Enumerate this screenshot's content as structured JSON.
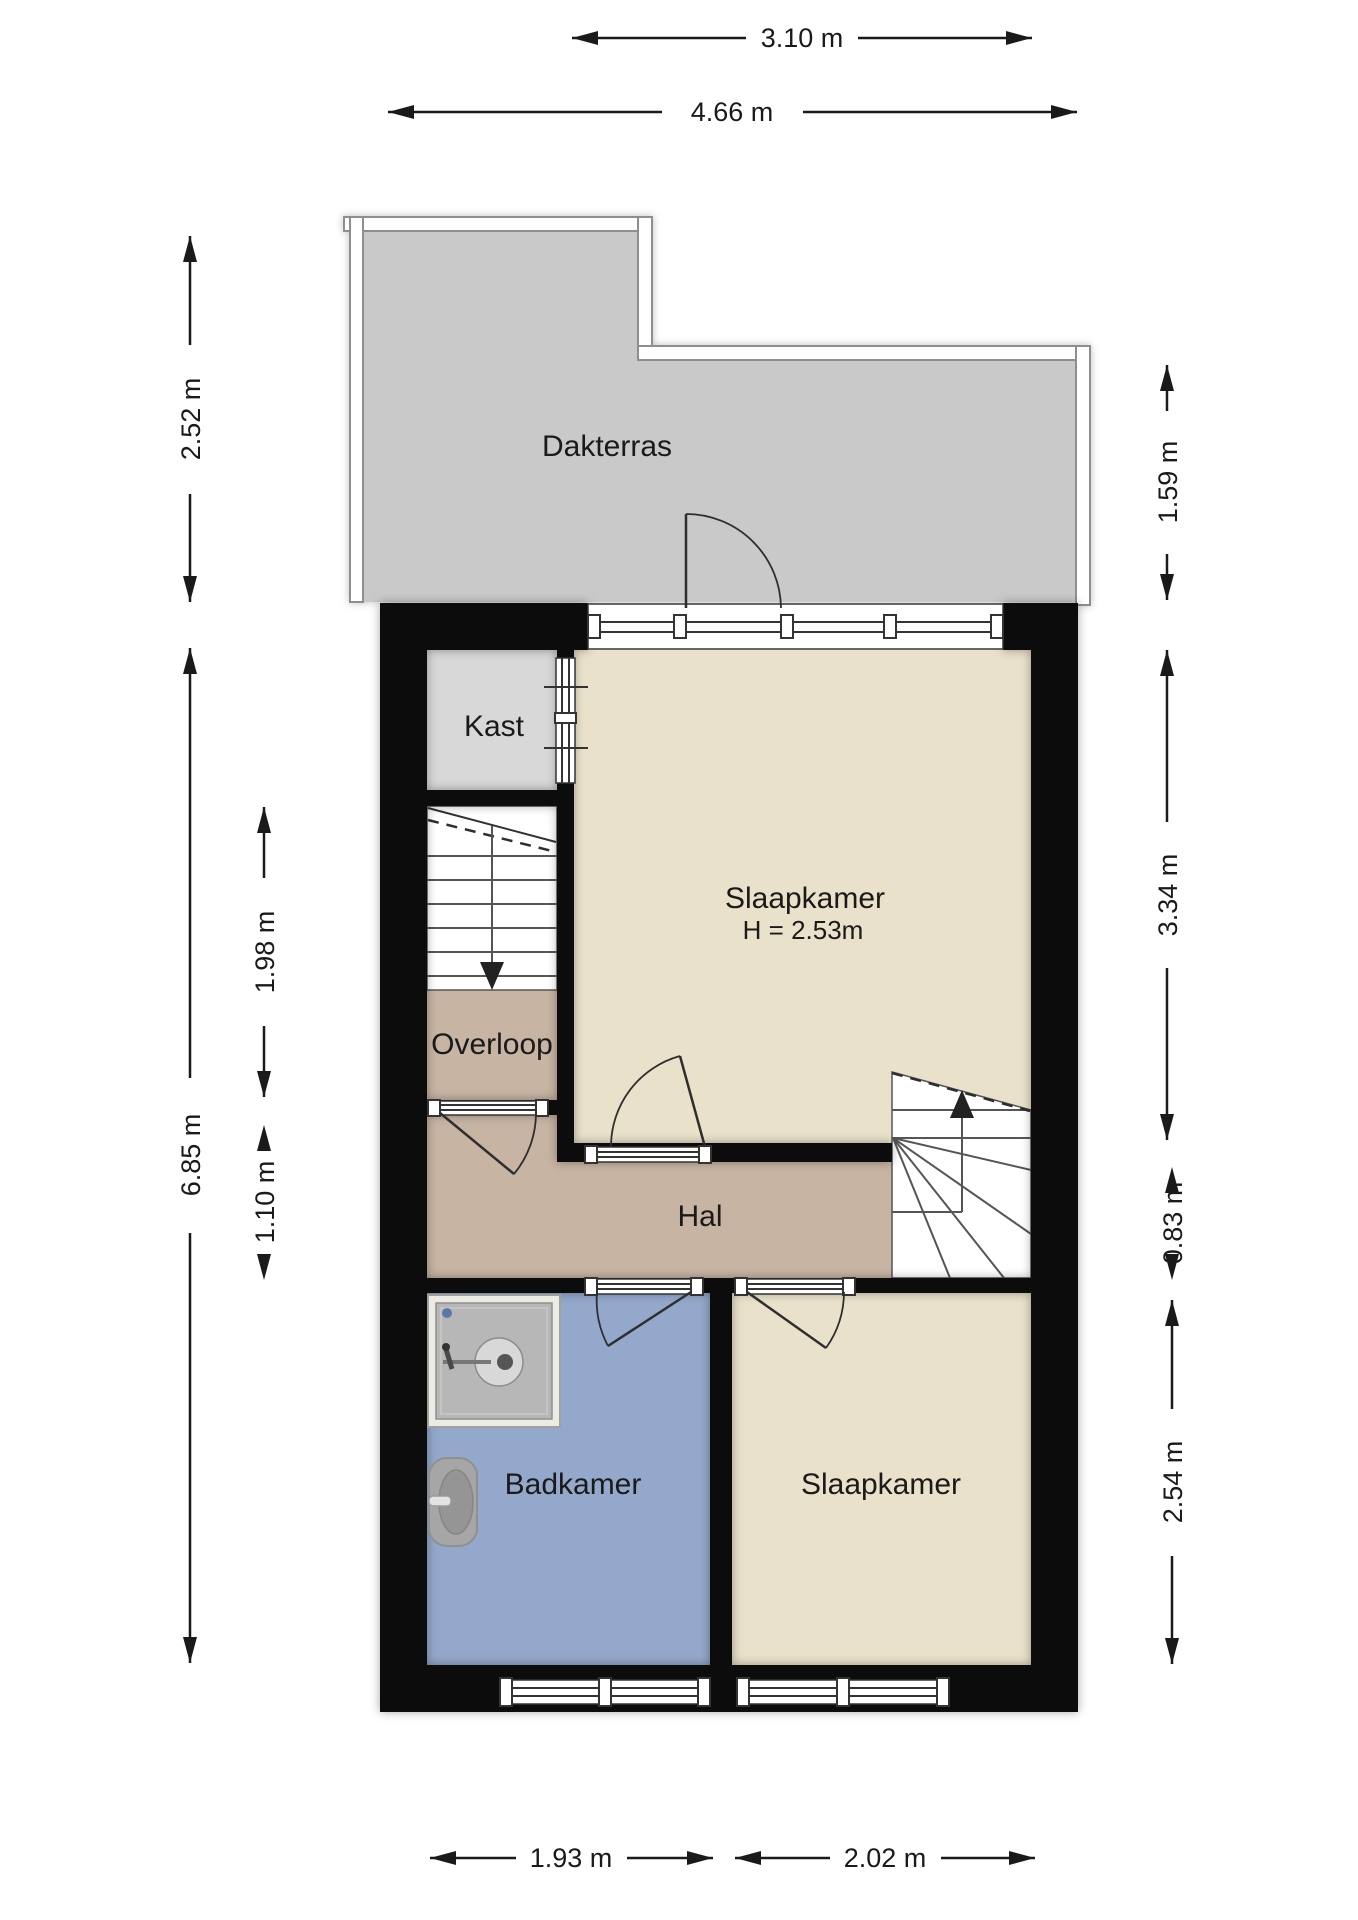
{
  "floorplan": {
    "rooms": [
      {
        "id": "dakterras",
        "label": "Dakterras"
      },
      {
        "id": "kast",
        "label": "Kast"
      },
      {
        "id": "slaapkamer-1",
        "label": "Slaapkamer",
        "sublabel": "H = 2.53m"
      },
      {
        "id": "overloop",
        "label": "Overloop"
      },
      {
        "id": "hal",
        "label": "Hal"
      },
      {
        "id": "badkamer",
        "label": "Badkamer"
      },
      {
        "id": "slaapkamer-2",
        "label": "Slaapkamer"
      }
    ],
    "dimensions": {
      "top": [
        {
          "label": "3.10 m"
        },
        {
          "label": "4.66 m"
        }
      ],
      "left": [
        {
          "label": "2.52 m"
        },
        {
          "label": "6.85 m"
        },
        {
          "label": "1.98 m"
        },
        {
          "label": "1.10 m"
        }
      ],
      "right": [
        {
          "label": "1.59 m"
        },
        {
          "label": "3.34 m"
        },
        {
          "label": "0.83 m"
        },
        {
          "label": "2.54 m"
        }
      ],
      "bottom": [
        {
          "label": "1.93 m"
        },
        {
          "label": "2.02 m"
        },
        {
          "label": "4.06 m"
        }
      ]
    },
    "colors": {
      "wall": "#0c0c0c",
      "terrace": "#c9c9c9",
      "terraceWall": "#ffffff",
      "terraceWallStroke": "#8e8e8e",
      "kast": "#d8d8d8",
      "bedroom": "#e9e1ca",
      "hall": "#c7b4a3",
      "bath": "#93a8cb",
      "stair": "#ffffff",
      "line": "#2e2e2e",
      "dim": "#1a1a1a"
    }
  }
}
